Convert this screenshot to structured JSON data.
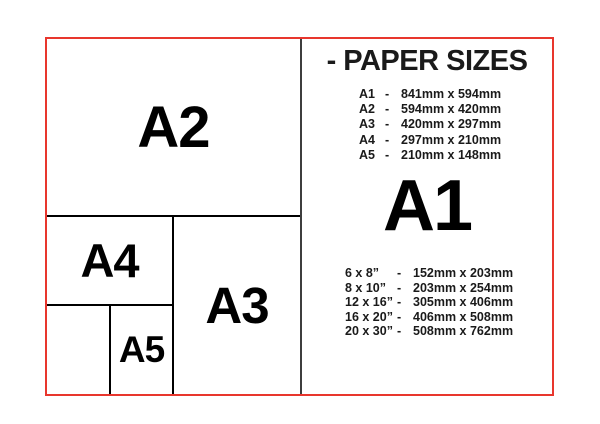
{
  "header": {
    "title": "- PAPER SIZES"
  },
  "featured": {
    "label": "A1"
  },
  "diagram": {
    "a2": {
      "label": "A2"
    },
    "a3": {
      "label": "A3"
    },
    "a4": {
      "label": "A4"
    },
    "a5": {
      "label": "A5"
    }
  },
  "a_series": {
    "separator": "-",
    "rows": [
      {
        "name": "A1",
        "dims": "841mm x 594mm"
      },
      {
        "name": "A2",
        "dims": "594mm x 420mm"
      },
      {
        "name": "A3",
        "dims": "420mm x 297mm"
      },
      {
        "name": "A4",
        "dims": "297mm x 210mm"
      },
      {
        "name": "A5",
        "dims": "210mm x 148mm"
      }
    ]
  },
  "inch_series": {
    "separator": "-",
    "rows": [
      {
        "name": "6 x 8”",
        "dims": "152mm x 203mm"
      },
      {
        "name": "8 x 10”",
        "dims": "203mm x 254mm"
      },
      {
        "name": "12 x 16”",
        "dims": "305mm x 406mm"
      },
      {
        "name": "16 x 20”",
        "dims": "406mm x 508mm"
      },
      {
        "name": "20 x 30”",
        "dims": "508mm x 762mm"
      }
    ]
  },
  "colors": {
    "border_red": "#e8362d",
    "inner_lines": "#000000",
    "divider_gray": "#3d3d3d",
    "text": "#1a1a1a"
  }
}
